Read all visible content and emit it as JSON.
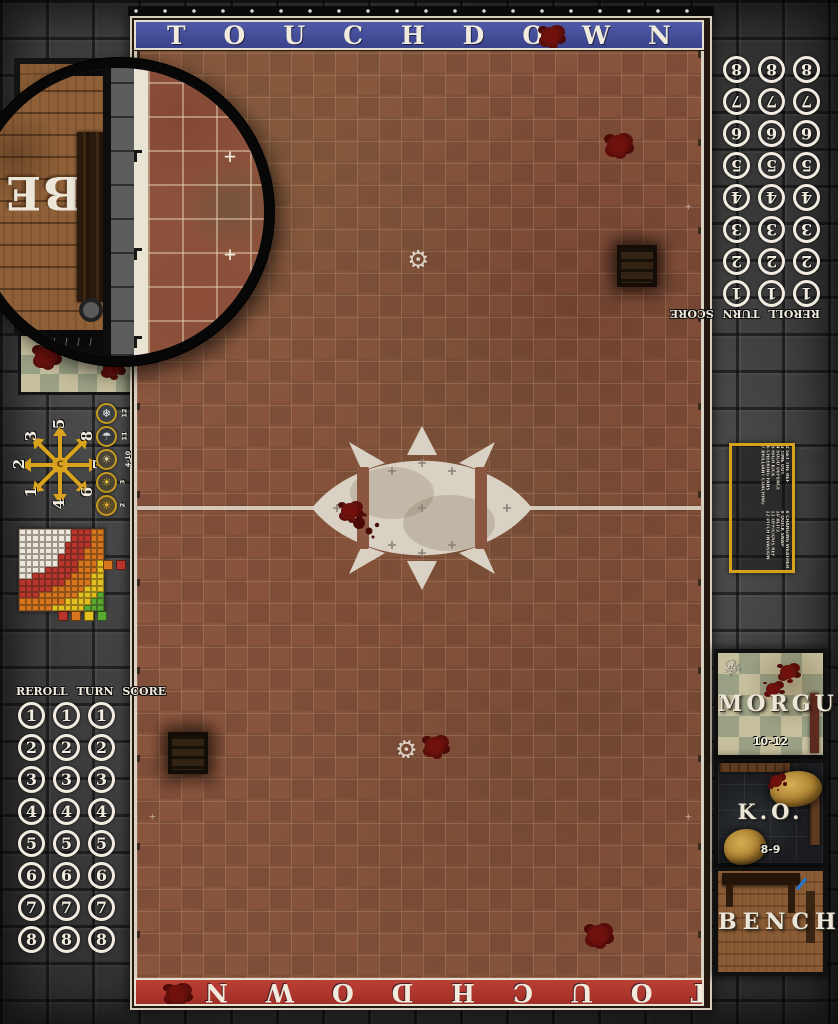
{
  "banners": {
    "top": {
      "text": "TOUCHDOWN",
      "bg_color": "#424c96"
    },
    "bottom": {
      "text": "TOUCHDOWN",
      "bg_color": "#ad352c"
    }
  },
  "turn_track": {
    "header": "REROLL TURN SCORE",
    "numbers": [
      "1",
      "2",
      "3",
      "4",
      "5",
      "6",
      "7",
      "8"
    ],
    "columns": 3
  },
  "scatter_template": {
    "numbers_clockwise_from_top": [
      "5",
      "8",
      "7",
      "6",
      "4",
      "1",
      "2",
      "3"
    ],
    "arrow_color": "#d9a31e"
  },
  "weather_table": {
    "entries_top_to_bottom": [
      {
        "roll": "12",
        "icon": "blizzard-icon",
        "glyph": "❄",
        "glyph_color": "#e8eef2",
        "bg_color": "#3a4044"
      },
      {
        "roll": "11",
        "icon": "rain-icon",
        "glyph": "☂",
        "glyph_color": "#cdd3d8",
        "bg_color": "#35393d"
      },
      {
        "roll": "4-10",
        "icon": "fair-weather-icon",
        "glyph": "☀",
        "glyph_color": "#e8d9a8",
        "bg_color": "#4a4436"
      },
      {
        "roll": "3",
        "icon": "sunny-icon",
        "glyph": "☀",
        "glyph_color": "#e8c23a",
        "bg_color": "#4a4430"
      },
      {
        "roll": "2",
        "icon": "scorching-sun-icon",
        "glyph": "☀",
        "glyph_color": "#f0b428",
        "bg_color": "#5a4a28"
      }
    ]
  },
  "kickoff_table": {
    "border_color": "#d6a21b",
    "rows": [
      "2 GET THE REF",
      "3 TIME OUT",
      "4 SOLID DEFENCE",
      "5 HIGH KICK",
      "6 CHEERING FANS",
      "7 BRILLIANT COACHING",
      "8 CHANGING WEATHER",
      "9 QUICK SNAP",
      "10 BLITZ",
      "11 OFFICIOUS REF",
      "12 PITCH INVASION"
    ]
  },
  "range_ruler": {
    "grid_size": 13,
    "bands": [
      {
        "color": "#ece7da",
        "max_distance": 7.8
      },
      {
        "color": "#b8352b",
        "max_distance": 10.8
      },
      {
        "color": "#d8761f",
        "max_distance": 13.6
      },
      {
        "color": "#e3c01f",
        "max_distance": 16.2
      },
      {
        "color": "#58a832",
        "max_distance": 99
      }
    ],
    "legend_right": [
      "#d8761f",
      "#b8352b"
    ],
    "legend_bottom": [
      "#b8352b",
      "#d8761f",
      "#e3c01f",
      "#58a832"
    ]
  },
  "dugouts": {
    "morgue": {
      "label": "MORGUE",
      "rolls": "10-12"
    },
    "ko": {
      "label": "K.O.",
      "rolls": "8-9"
    },
    "bench": {
      "label": "BENCH"
    },
    "left_bench_visible_letters": "BE"
  }
}
